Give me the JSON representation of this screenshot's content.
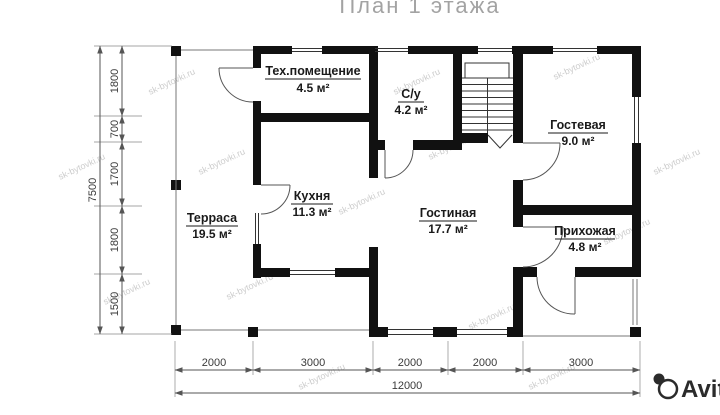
{
  "title": "План 1 этажа",
  "watermark": "sk-bytovki.ru",
  "brand": "Avito",
  "rooms": [
    {
      "name": "Тех.помещение",
      "area": "4.5 м²"
    },
    {
      "name": "С/у",
      "area": "4.2 м²"
    },
    {
      "name": "Гостевая",
      "area": "9.0 м²"
    },
    {
      "name": "Кухня",
      "area": "11.3 м²"
    },
    {
      "name": "Гостиная",
      "area": "17.7 м²"
    },
    {
      "name": "Прихожая",
      "area": "4.8 м²"
    },
    {
      "name": "Терраса",
      "area": "19.5 м²"
    }
  ],
  "dimensions": {
    "left": {
      "total": "7500",
      "segments": [
        "1800",
        "700",
        "1700",
        "1800",
        "1500"
      ]
    },
    "bottom": {
      "total": "12000",
      "segments": [
        "2000",
        "3000",
        "2000",
        "2000",
        "3000"
      ]
    }
  },
  "colors": {
    "wall": "#111111",
    "dimension_lines": "#555555",
    "room_text": "#1a1a1a",
    "watermark": "#c4c4c4",
    "title": "#a3a3a3",
    "brand": "#2b2b2b"
  }
}
